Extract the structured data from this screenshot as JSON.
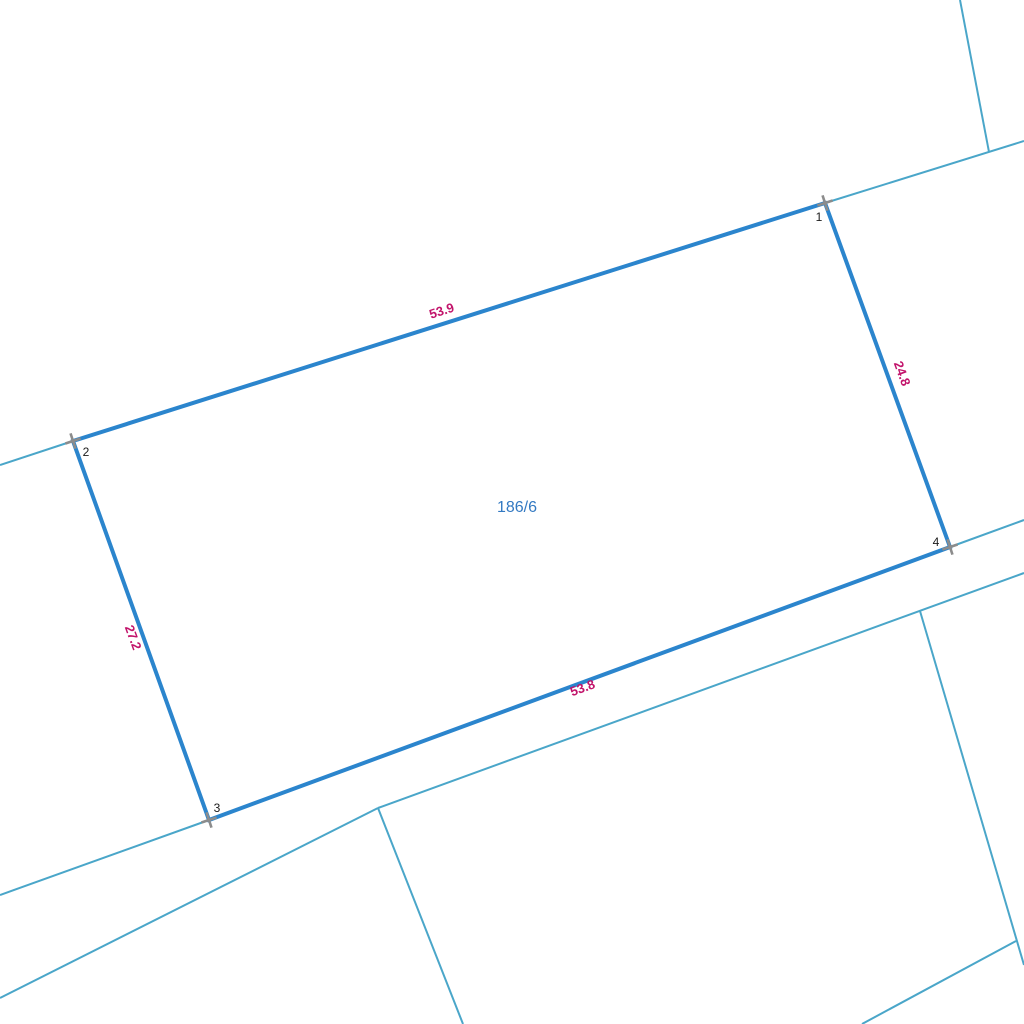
{
  "map": {
    "background": "#ffffff",
    "colors": {
      "parcel_outline": "#2b85cd",
      "neighbor_line": "#4aa6c9",
      "dimension_text": "#c2146b",
      "parcel_label_text": "#3379c2",
      "vertex_number_text": "#1a1a1a",
      "vertex_marker": "#8c8c8c"
    },
    "parcel": {
      "label": "186/6",
      "label_position": {
        "x": 517,
        "y": 512
      },
      "vertices": [
        {
          "number": "1",
          "x": 825,
          "y": 203,
          "number_x": 819,
          "number_y": 221
        },
        {
          "number": "2",
          "x": 73,
          "y": 441,
          "number_x": 86,
          "number_y": 456
        },
        {
          "number": "3",
          "x": 209,
          "y": 820,
          "number_x": 217,
          "number_y": 812
        },
        {
          "number": "4",
          "x": 950,
          "y": 547,
          "number_x": 936,
          "number_y": 546
        }
      ],
      "outline_width": 4
    },
    "dimensions": [
      {
        "text": "53.9",
        "x": 443,
        "y": 315,
        "angle": -18
      },
      {
        "text": "24.8",
        "x": 898,
        "y": 375,
        "angle": 70
      },
      {
        "text": "27.2",
        "x": 129,
        "y": 639,
        "angle": 70
      },
      {
        "text": "53.8",
        "x": 584,
        "y": 692,
        "angle": -20
      }
    ],
    "neighbor_lines": [
      {
        "x1": 0,
        "y1": 465,
        "x2": 73,
        "y2": 441
      },
      {
        "x1": 825,
        "y1": 203,
        "x2": 1024,
        "y2": 141
      },
      {
        "x1": 960,
        "y1": 0,
        "x2": 989,
        "y2": 152
      },
      {
        "x1": 0,
        "y1": 895,
        "x2": 209,
        "y2": 820
      },
      {
        "x1": 950,
        "y1": 547,
        "x2": 1024,
        "y2": 520
      },
      {
        "x1": 0,
        "y1": 998,
        "x2": 378,
        "y2": 808
      },
      {
        "x1": 378,
        "y1": 808,
        "x2": 1024,
        "y2": 573
      },
      {
        "x1": 378,
        "y1": 808,
        "x2": 463,
        "y2": 1024
      },
      {
        "x1": 920,
        "y1": 611,
        "x2": 1024,
        "y2": 965
      },
      {
        "x1": 1016,
        "y1": 941,
        "x2": 862,
        "y2": 1024
      }
    ],
    "neighbor_line_width": 2,
    "vertex_marker_style": {
      "arm_length": 8,
      "stroke_width": 2.6,
      "angle": -18
    }
  }
}
